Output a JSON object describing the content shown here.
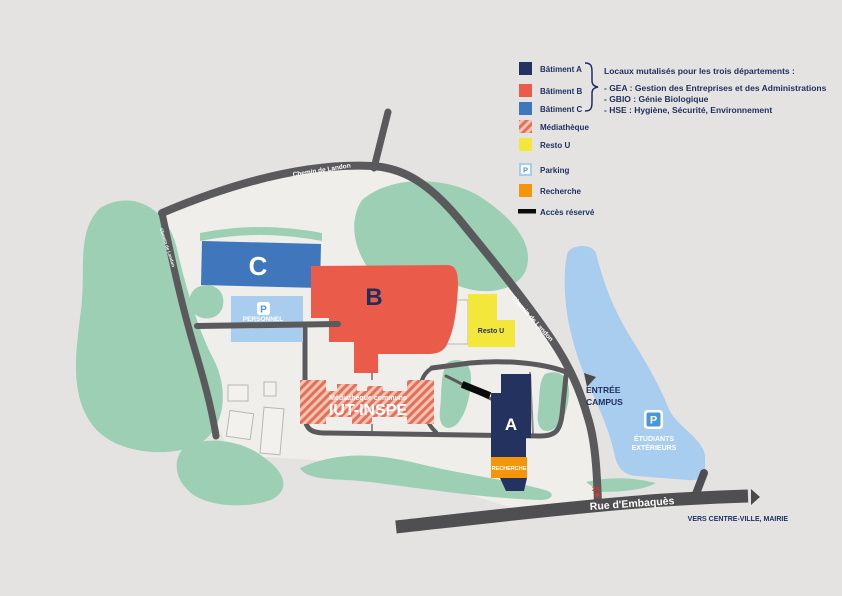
{
  "colors": {
    "background": "#e4e3e1",
    "campus": "#efeeeb",
    "green": "#9ccfb4",
    "road": "#5a5a5c",
    "road_dark": "#4f4f52",
    "navy": "#1f2e5e",
    "batiment_a": "#243260",
    "batiment_b": "#ea5c49",
    "batiment_c": "#3f76bc",
    "resto_u": "#f4e73c",
    "parking": "#a9cdee",
    "recherche": "#f5950a",
    "acces": "#0b0b0b",
    "hatch_bg": "#f2c4b4",
    "hatch_stripe": "#e2705a",
    "p_icon_blue": "#4a96d6",
    "red_marker": "#e8312a",
    "white": "#ffffff"
  },
  "legend": {
    "items": [
      {
        "label": "Bâtiment A",
        "color": "#243260"
      },
      {
        "label": "Bâtiment B",
        "color": "#ea5c49"
      },
      {
        "label": "Bâtiment C",
        "color": "#3f76bc"
      },
      {
        "label": "Médiathèque",
        "color": "#f2c4b4"
      },
      {
        "label": "Resto U",
        "color": "#f4e73c"
      },
      {
        "label": "Parking",
        "color": "#a9cdee"
      },
      {
        "label": "Recherche",
        "color": "#f5950a"
      },
      {
        "label": "Accès réservé",
        "color": "#0b0b0b"
      }
    ],
    "parking_icon_letter": "P",
    "shared_title": "Locaux mutalisés pour les trois départements :",
    "shared_lines": [
      "- GEA : Gestion des Entreprises et des Administrations",
      "- GBIO : Génie Biologique",
      "- HSE : Hygiène, Sécurité, Environnement"
    ]
  },
  "map": {
    "buildings": {
      "a": "A",
      "b": "B",
      "c": "C",
      "resto_u": "Resto U",
      "recherche": "RECHERCHE",
      "mediatheque_line1": "Médiathèque commune",
      "mediatheque_line2": "IUT-INSPE"
    },
    "parkings": {
      "personnel": "PERSONNEL",
      "p_letter": "P",
      "etudiants_line1": "ÉTUDIANTS",
      "etudiants_line2": "EXTÉRIEURS"
    },
    "roads": {
      "top": "Chemin de Landon",
      "right": "Chemin de Landon",
      "left": "Chemin de Landon",
      "street": "Rue d'Embaquès",
      "street_number": "24",
      "destination": "VERS CENTRE-VILLE, MAIRIE"
    },
    "entrance_line1": "ENTRÉE",
    "entrance_line2": "CAMPUS"
  }
}
